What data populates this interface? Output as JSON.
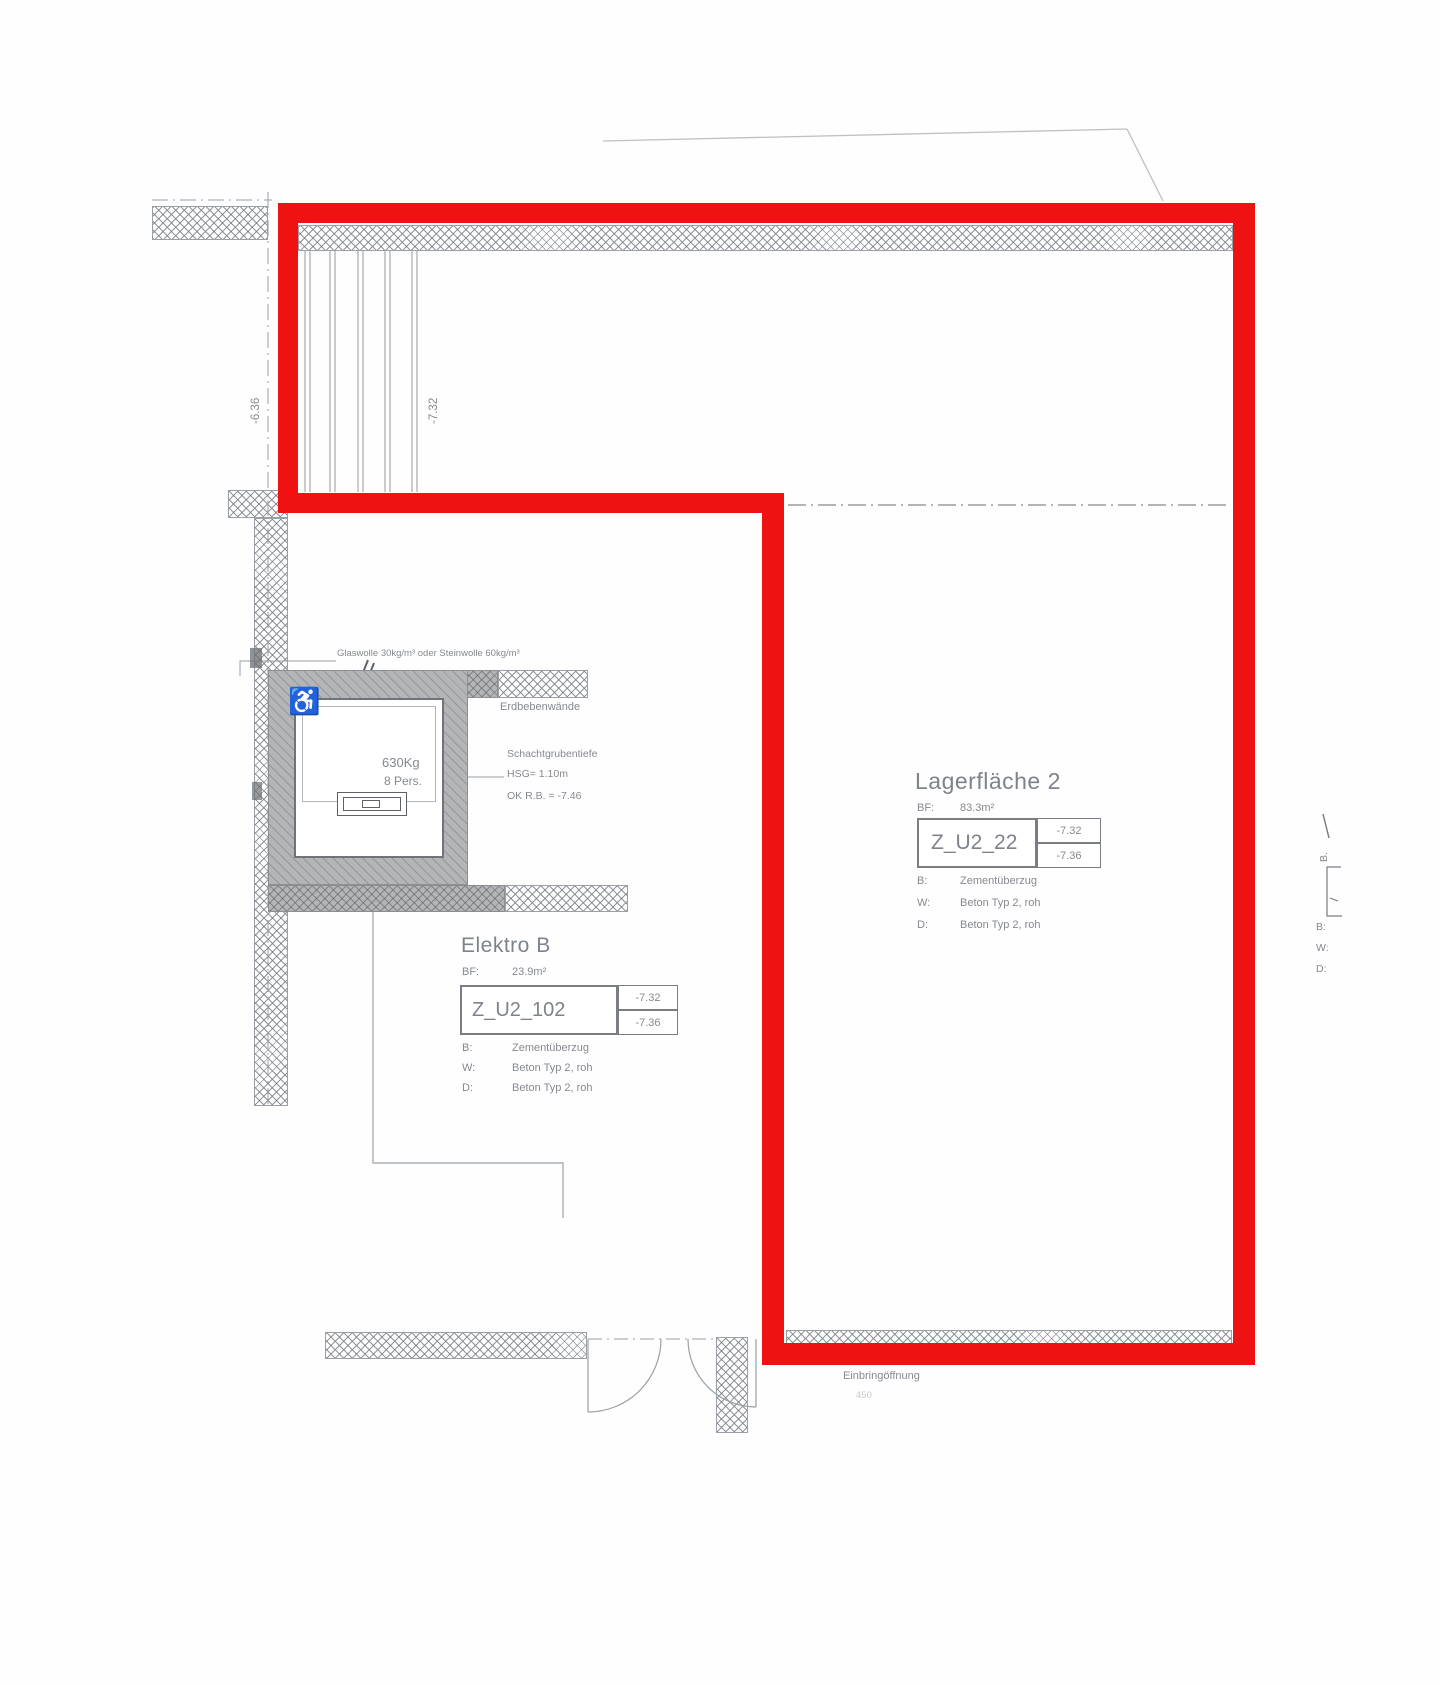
{
  "drawing": {
    "insulation_note": "Glaswolle 30kg/m³ oder Steinwolle 60kg/m³",
    "erdbeben_label": "Erdbebenwände",
    "dim_left": "-6.36",
    "dim_mid": "-7.32",
    "einbring_label": "Einbringöffnung",
    "einbring_dim": "450",
    "shaft": {
      "capacity": "630Kg",
      "persons": "8 Pers.",
      "wheelchair_icon": "♿",
      "pit_line1": "Schachtgrubentiefe",
      "pit_line2": "HSG= 1.10m",
      "pit_line3": "OK R.B. = -7.46"
    }
  },
  "rooms": {
    "elektro": {
      "title": "Elektro B",
      "bf_label": "BF:",
      "bf_value": "23.9m²",
      "code": "Z_U2_102",
      "level_top": "-7.32",
      "level_bottom": "-7.36",
      "b_label": "B:",
      "b_value": "Zementüberzug",
      "w_label": "W:",
      "w_value": "Beton Typ 2, roh",
      "d_label": "D:",
      "d_value": "Beton Typ 2, roh"
    },
    "lager": {
      "title": "Lagerfläche 2",
      "bf_label": "BF:",
      "bf_value": "83.3m²",
      "code": "Z_U2_22",
      "level_top": "-7.32",
      "level_bottom": "-7.36",
      "b_label": "B:",
      "b_value": "Zementüberzug",
      "w_label": "W:",
      "w_value": "Beton Typ 2, roh",
      "d_label": "D:",
      "d_value": "Beton Typ 2, roh"
    }
  },
  "edge_fragment": {
    "rotated_b": "B.",
    "b": "B:",
    "w": "W:",
    "d": "D:"
  },
  "colors": {
    "highlight_red": "#ee1212",
    "line_gray": "#9aa0a6",
    "text_gray": "#85898f",
    "wall_gray": "#b4b5b6"
  }
}
